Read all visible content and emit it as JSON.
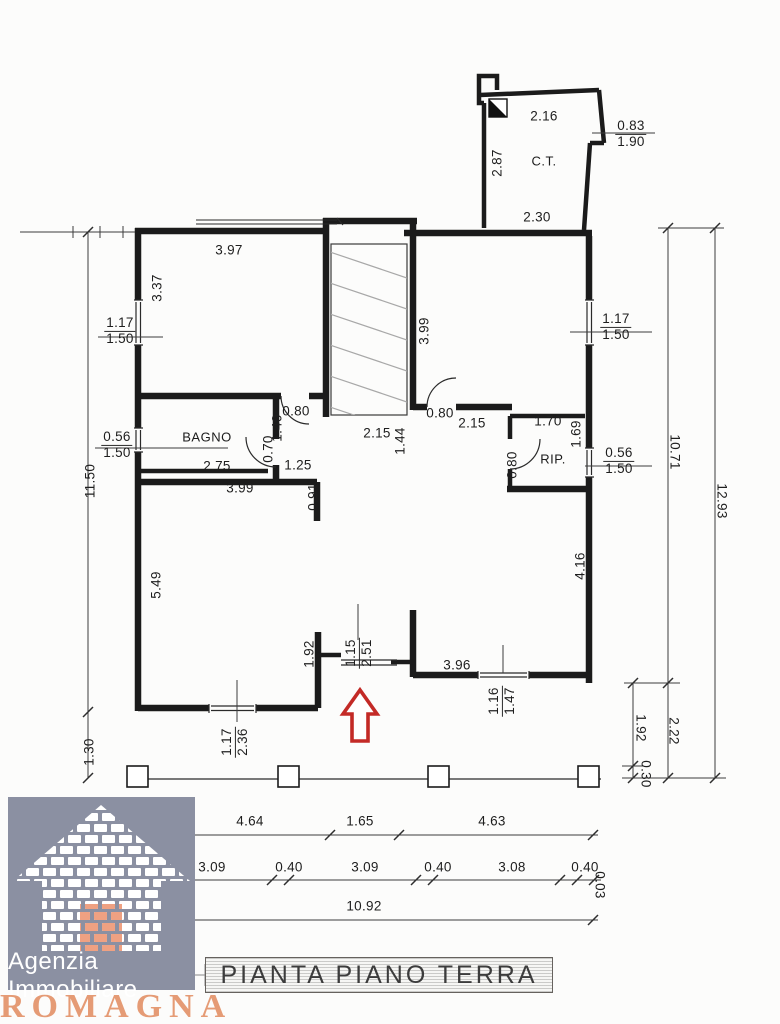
{
  "title": {
    "label": "PIANTA PIANO TERRA"
  },
  "logo": {
    "line1": "Agenzia Immobiliare",
    "line2": "ROMAGNA",
    "bg_color": "#8b90a2",
    "accent_color": "#e59b75"
  },
  "rooms": {
    "bagno": {
      "label": "BAGNO"
    },
    "rip": {
      "label": "RIP."
    },
    "ct": {
      "label": "C.T."
    }
  },
  "plan": {
    "entrance_arrow_color": "#c32a26",
    "wall_color": "#1b1b1b",
    "hatch_color": "#a8a8a8"
  },
  "dims": [
    {
      "id": "d397",
      "t": "3.97",
      "x": 229,
      "y": 250,
      "r": 0
    },
    {
      "id": "d216",
      "t": "2.16",
      "x": 544,
      "y": 116,
      "r": 0
    },
    {
      "id": "d230",
      "t": "2.30",
      "x": 537,
      "y": 217,
      "r": 0
    },
    {
      "id": "d287",
      "t": "2.87",
      "x": 497,
      "y": 163,
      "r": -90
    },
    {
      "id": "d337",
      "t": "3.37",
      "x": 157,
      "y": 288,
      "r": -90
    },
    {
      "id": "d1150",
      "t": "11.50",
      "x": 90,
      "y": 481,
      "r": -90
    },
    {
      "id": "d130",
      "t": "1.30",
      "x": 89,
      "y": 752,
      "r": -90
    },
    {
      "id": "d275",
      "t": "2.75",
      "x": 217,
      "y": 466,
      "r": 0
    },
    {
      "id": "d399b",
      "t": "3.99",
      "x": 240,
      "y": 488,
      "r": 0
    },
    {
      "id": "d125",
      "t": "1.25",
      "x": 298,
      "y": 465,
      "r": 0
    },
    {
      "id": "d091",
      "t": "0.91",
      "x": 313,
      "y": 497,
      "r": -90
    },
    {
      "id": "d080a",
      "t": "0.80",
      "x": 296,
      "y": 411,
      "r": 0
    },
    {
      "id": "d140",
      "t": "1.40",
      "x": 277,
      "y": 428,
      "r": -90
    },
    {
      "id": "d070",
      "t": "0.70",
      "x": 268,
      "y": 449,
      "r": -90
    },
    {
      "id": "d215a",
      "t": "2.15",
      "x": 377,
      "y": 433,
      "r": 0
    },
    {
      "id": "d144",
      "t": "1.44",
      "x": 400,
      "y": 441,
      "r": -90
    },
    {
      "id": "d399",
      "t": "3.99",
      "x": 424,
      "y": 331,
      "r": -90
    },
    {
      "id": "d080b",
      "t": "0.80",
      "x": 440,
      "y": 413,
      "r": 0
    },
    {
      "id": "d215b",
      "t": "2.15",
      "x": 472,
      "y": 423,
      "r": 0
    },
    {
      "id": "d170",
      "t": "1.70",
      "x": 548,
      "y": 421,
      "r": 0
    },
    {
      "id": "d169",
      "t": "1.69",
      "x": 576,
      "y": 434,
      "r": -90
    },
    {
      "id": "d080c",
      "t": "0.80",
      "x": 512,
      "y": 465,
      "r": -90
    },
    {
      "id": "d549",
      "t": "5.49",
      "x": 156,
      "y": 585,
      "r": -90
    },
    {
      "id": "d416",
      "t": "4.16",
      "x": 580,
      "y": 566,
      "r": -90
    },
    {
      "id": "d192a",
      "t": "1.92",
      "x": 309,
      "y": 654,
      "r": -90
    },
    {
      "id": "d396",
      "t": "3.96",
      "x": 457,
      "y": 665,
      "r": 0
    },
    {
      "id": "d1071",
      "t": "10.71",
      "x": 675,
      "y": 452,
      "r": 90
    },
    {
      "id": "d1293",
      "t": "12.93",
      "x": 722,
      "y": 501,
      "r": 90
    },
    {
      "id": "d222",
      "t": "2.22",
      "x": 674,
      "y": 731,
      "r": 90
    },
    {
      "id": "d192b",
      "t": "1.92",
      "x": 641,
      "y": 728,
      "r": 90
    },
    {
      "id": "d030",
      "t": "0.30",
      "x": 646,
      "y": 774,
      "r": 90
    },
    {
      "id": "d464",
      "t": "4.64",
      "x": 250,
      "y": 821,
      "r": 0
    },
    {
      "id": "d165",
      "t": "1.65",
      "x": 360,
      "y": 821,
      "r": 0
    },
    {
      "id": "d463",
      "t": "4.63",
      "x": 492,
      "y": 821,
      "r": 0
    },
    {
      "id": "d309a",
      "t": "3.09",
      "x": 212,
      "y": 867,
      "r": 0
    },
    {
      "id": "d040a",
      "t": "0.40",
      "x": 289,
      "y": 867,
      "r": 0
    },
    {
      "id": "d309b",
      "t": "3.09",
      "x": 365,
      "y": 867,
      "r": 0
    },
    {
      "id": "d040b",
      "t": "0.40",
      "x": 438,
      "y": 867,
      "r": 0
    },
    {
      "id": "d308",
      "t": "3.08",
      "x": 512,
      "y": 867,
      "r": 0
    },
    {
      "id": "d040c",
      "t": "0.40",
      "x": 585,
      "y": 867,
      "r": 0
    },
    {
      "id": "d003",
      "t": "0.03",
      "x": 600,
      "y": 885,
      "r": 90
    },
    {
      "id": "d1092",
      "t": "10.92",
      "x": 364,
      "y": 906,
      "r": 0
    }
  ],
  "pairs": [
    {
      "id": "pL1",
      "a": "1.17",
      "b": "1.50",
      "x": 120,
      "y": 331,
      "r": 0
    },
    {
      "id": "pL2",
      "a": "0.56",
      "b": "1.50",
      "x": 117,
      "y": 445,
      "r": 0
    },
    {
      "id": "pR1",
      "a": "1.17",
      "b": "1.50",
      "x": 616,
      "y": 327,
      "r": 0
    },
    {
      "id": "pR2",
      "a": "0.56",
      "b": "1.50",
      "x": 619,
      "y": 461,
      "r": 0
    },
    {
      "id": "pCT",
      "a": "0.83",
      "b": "1.90",
      "x": 631,
      "y": 134,
      "r": 0
    },
    {
      "id": "pE",
      "a": "1.15",
      "b": "2.51",
      "x": 359,
      "y": 653,
      "r": -90
    },
    {
      "id": "pW1",
      "a": "1.16",
      "b": "1.47",
      "x": 502,
      "y": 701,
      "r": -90
    },
    {
      "id": "pW2",
      "a": "1.17",
      "b": "2.36",
      "x": 235,
      "y": 742,
      "r": -90
    }
  ]
}
